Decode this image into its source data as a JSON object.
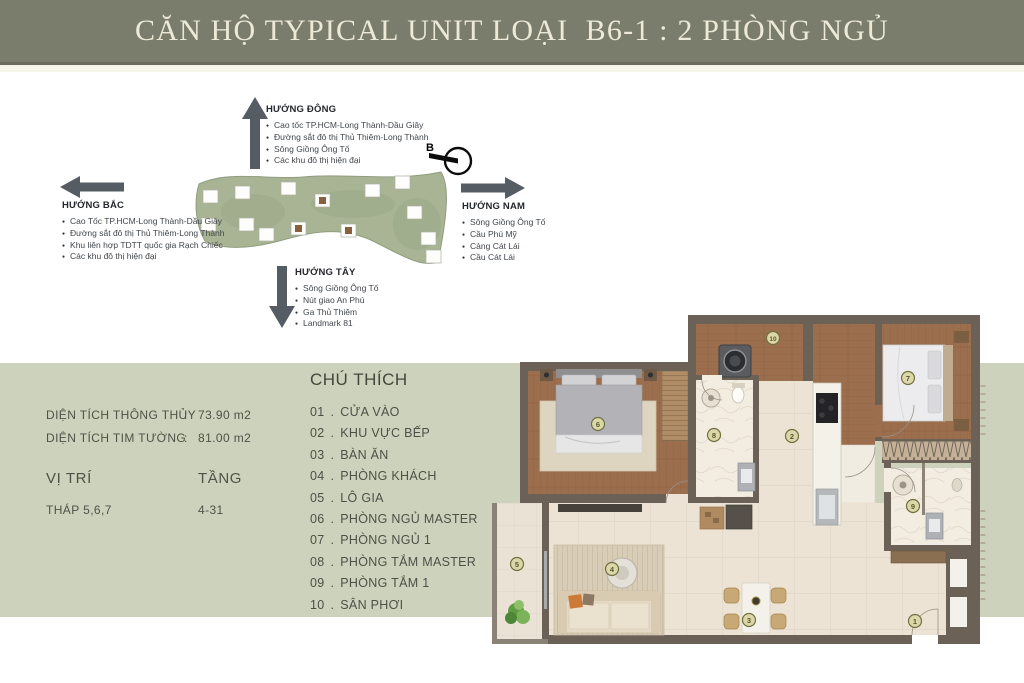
{
  "header": {
    "title": "CĂN HỘ TYPICAL UNIT LOẠI  B6-1 : 2 PHÒNG NGỦ"
  },
  "compass": {
    "north_label": "B"
  },
  "directions": {
    "east": {
      "title": "HƯỚNG ĐÔNG",
      "items": [
        "Cao tốc TP.HCM-Long Thành-Dầu Giây",
        "Đường sắt đô thị Thủ Thiêm-Long Thành",
        "Sông Giồng Ông Tố",
        "Các khu đô thị hiện đại"
      ]
    },
    "north": {
      "title": "HƯỚNG BẮC",
      "items": [
        "Cao Tốc TP.HCM-Long Thành-Dầu Giây",
        "Đường sắt đô thị Thủ Thiêm-Long Thành",
        "Khu liên hợp TDTT quốc gia Rạch Chiếc",
        "Các khu đô thị hiện đại"
      ]
    },
    "south": {
      "title": "HƯỚNG NAM",
      "items": [
        "Sông Giồng Ông Tố",
        "Cầu Phú Mỹ",
        "Cảng Cát Lái",
        "Cầu Cát Lái"
      ]
    },
    "west": {
      "title": "HƯỚNG TÂY",
      "items": [
        "Sông Giồng Ông Tố",
        "Nút giao An Phú",
        "Ga Thủ Thiêm",
        "Landmark 81"
      ]
    }
  },
  "specs": {
    "separator": ":",
    "rows": [
      {
        "label": "DIỆN TÍCH THÔNG THỦY",
        "value": "73.90 m2"
      },
      {
        "label": "DIỆN TÍCH TIM TƯỜNG",
        "value": "81.00 m2"
      }
    ],
    "location_label": "VỊ TRÍ",
    "floor_label": "TẦNG",
    "location_value": "THÁP 5,6,7",
    "floor_value": "4-31"
  },
  "legend": {
    "title": "CHÚ THÍCH",
    "separator": ".",
    "items": [
      {
        "num": "01",
        "label": "CỬA VÀO"
      },
      {
        "num": "02",
        "label": "KHU VỰC BẾP"
      },
      {
        "num": "03",
        "label": "BÀN ĂN"
      },
      {
        "num": "04",
        "label": "PHÒNG KHÁCH"
      },
      {
        "num": "05",
        "label": "LÔ GIA"
      },
      {
        "num": "06",
        "label": "PHÒNG NGỦ MASTER"
      },
      {
        "num": "07",
        "label": "PHÒNG NGỦ 1"
      },
      {
        "num": "08",
        "label": "PHÒNG TẮM MASTER"
      },
      {
        "num": "09",
        "label": "PHÒNG TẮM 1"
      },
      {
        "num": "10",
        "label": "SÂN PHƠI"
      }
    ]
  },
  "floorplan": {
    "markers": [
      "1",
      "2",
      "3",
      "4",
      "5",
      "6",
      "7",
      "8",
      "9",
      "10"
    ]
  },
  "colors": {
    "header_bg": "#7a7d6b",
    "header_text": "#ece9d7",
    "band_bg": "#cdd2bc",
    "arrow": "#565c63",
    "wall": "#6b6156",
    "wood_floor": "#9b6e4d",
    "tile_floor": "#ece3d5",
    "marker_fill": "#dcd6ab",
    "marker_ring": "#70703e",
    "site_map_green": "#a8b494",
    "highlight_tower": "#8a5f3e"
  }
}
